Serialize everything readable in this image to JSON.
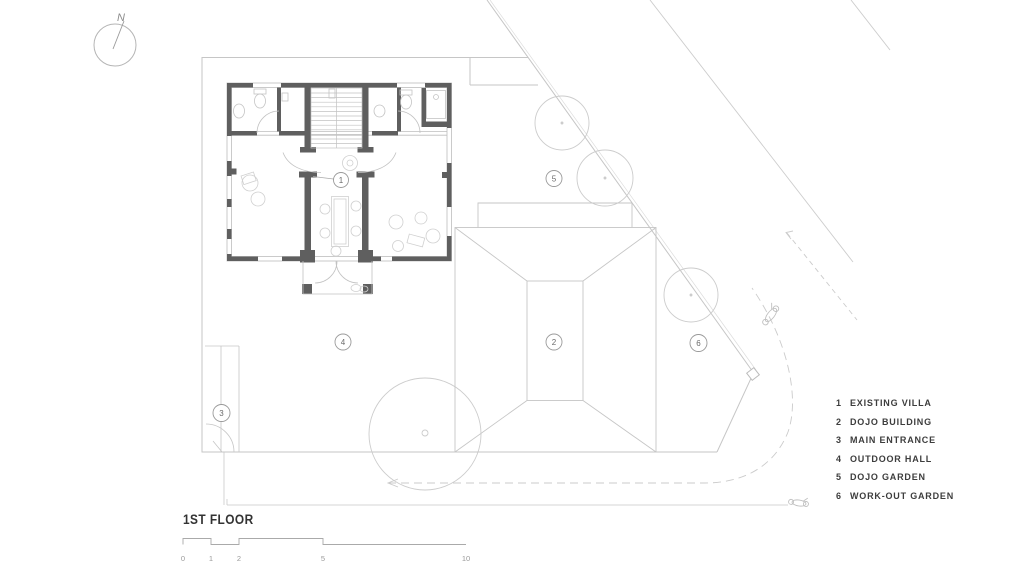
{
  "drawing": {
    "title": "1ST FLOOR",
    "north_label": "N"
  },
  "scale_bar": {
    "ticks": [
      "0",
      "1",
      "2",
      "5",
      "10"
    ]
  },
  "legend": {
    "items": [
      {
        "num": "1",
        "label": "EXISTING VILLA"
      },
      {
        "num": "2",
        "label": "DOJO BUILDING"
      },
      {
        "num": "3",
        "label": "MAIN ENTRANCE"
      },
      {
        "num": "4",
        "label": "OUTDOOR HALL"
      },
      {
        "num": "5",
        "label": "DOJO GARDEN"
      },
      {
        "num": "6",
        "label": "WORK-OUT GARDEN"
      }
    ]
  },
  "markers": [
    {
      "label": "1"
    },
    {
      "label": "2"
    },
    {
      "label": "3"
    },
    {
      "label": "4"
    },
    {
      "label": "5"
    },
    {
      "label": "6"
    }
  ],
  "colors": {
    "wall": "#5f5f5f",
    "thin_line": "#bdbdbd",
    "site_line": "#c6c6c6",
    "furniture": "#d0d0d0",
    "text_dark": "#3d3d3d",
    "text_gray": "#9a9a9a",
    "background": "#ffffff"
  }
}
